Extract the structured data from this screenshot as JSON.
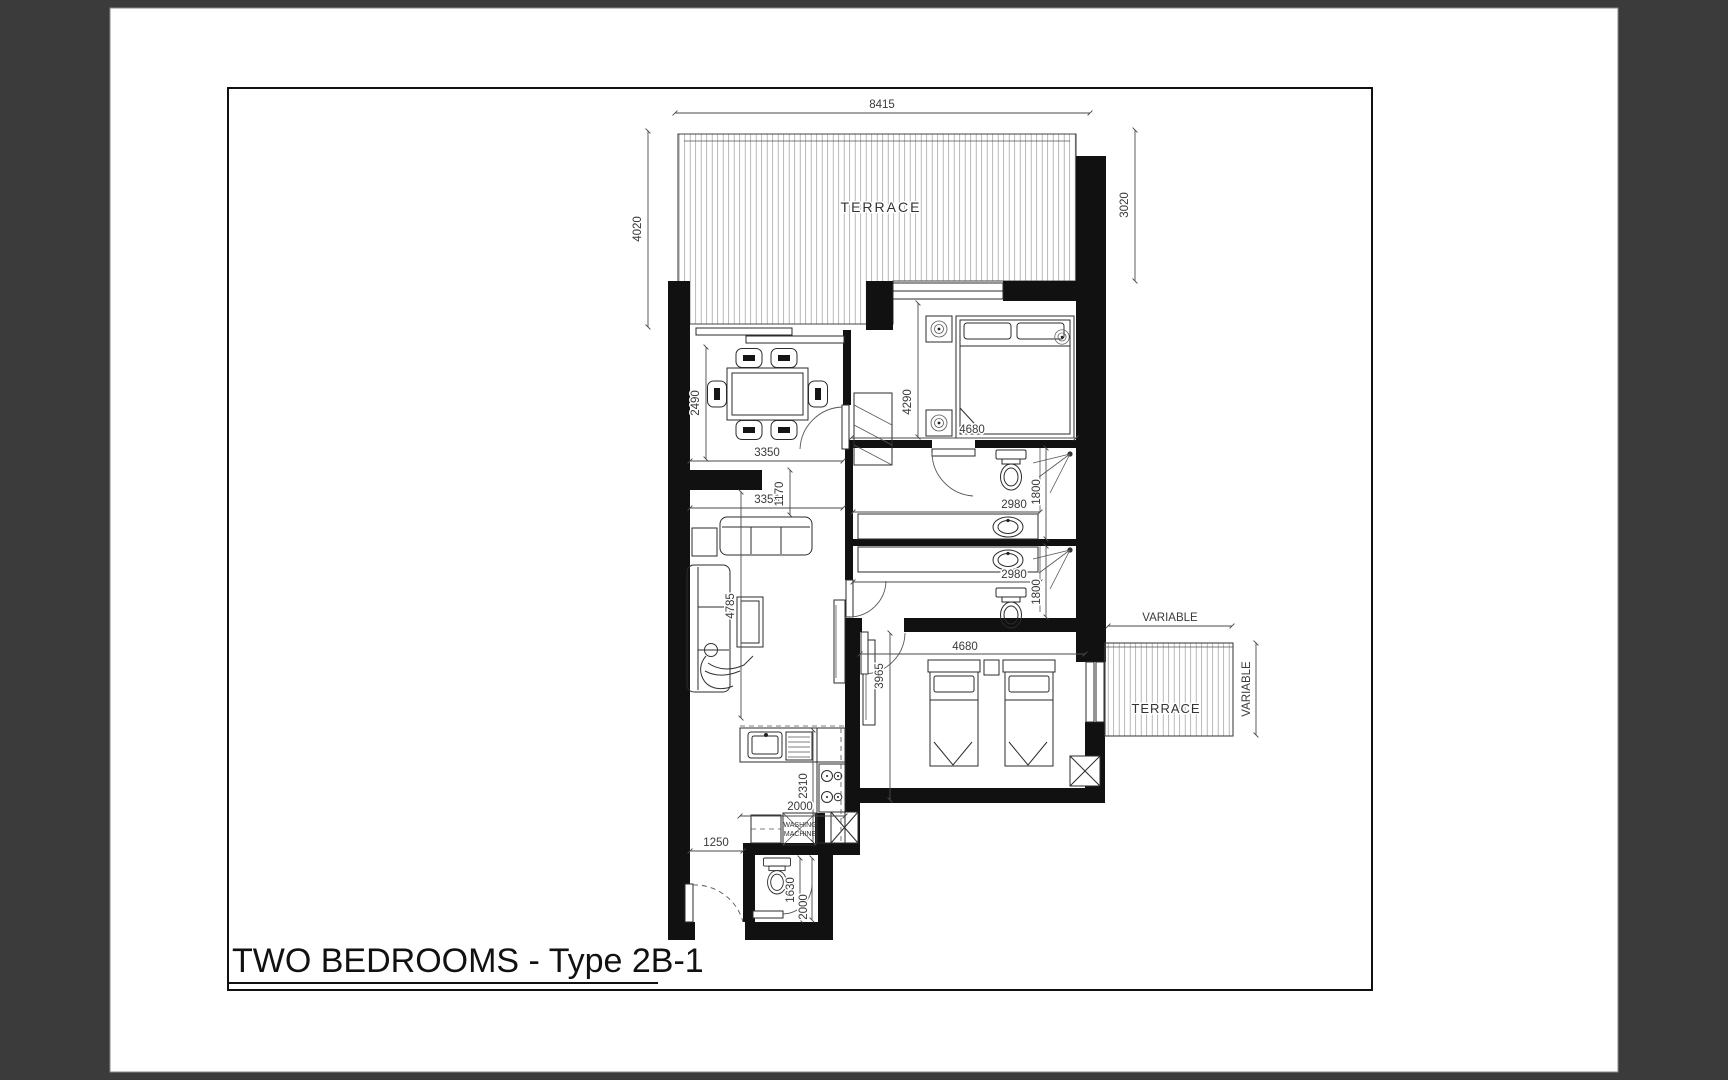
{
  "page": {
    "title": "TWO BEDROOMS - Type 2B-1",
    "background_color": "#3b3b3c",
    "paper_color": "#ffffff",
    "line_color": "#111111"
  },
  "labels": {
    "terrace_top": "TERRACE",
    "terrace_side": "TERRACE",
    "washing_machine_line1": "WASHING",
    "washing_machine_line2": "MACHINE"
  },
  "dims": {
    "terrace_top_width": "8415",
    "terrace_top_depth_left": "4020",
    "terrace_top_depth_right": "3020",
    "dining_depth": "2490",
    "dining_width": "3350",
    "living_width": "3350",
    "bedroom1_depth": "4290",
    "bedroom1_width": "4680",
    "bathroom1_width": "2980",
    "bathroom1_depth": "1800",
    "bathroom2_width": "2980",
    "bathroom2_depth": "1800",
    "hallway_width": "1170",
    "living_depth": "4785",
    "bedroom2_width": "4680",
    "bedroom2_depth": "3965",
    "kitchen_depth": "2310",
    "kitchen_width": "2000",
    "entry_width": "1250",
    "wc_depth": "1630",
    "wc_width": "2000",
    "terrace_side_width": "VARIABLE",
    "terrace_side_depth": "VARIABLE"
  }
}
